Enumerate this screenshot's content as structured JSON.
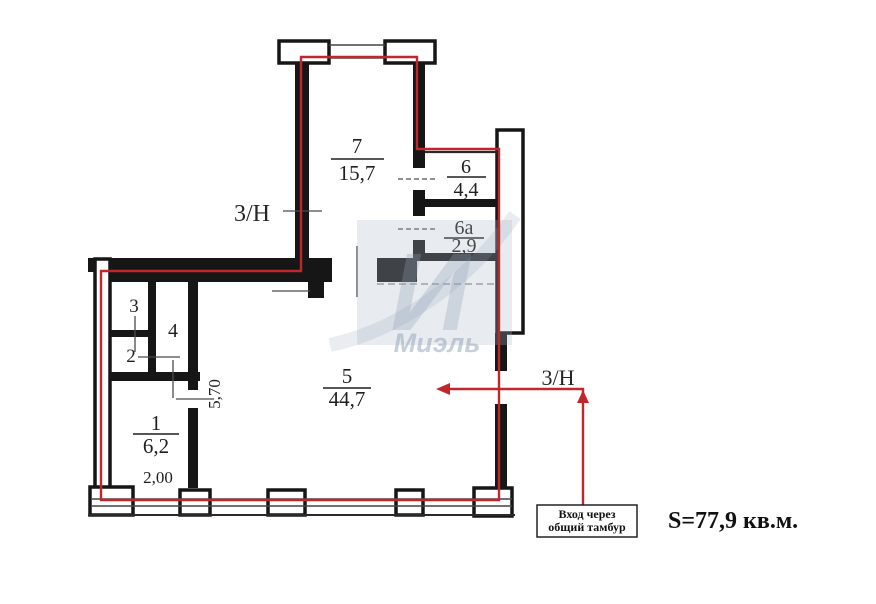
{
  "rooms": {
    "r1": {
      "number": "1",
      "area": "6,2"
    },
    "r2": {
      "number": "2"
    },
    "r3": {
      "number": "3"
    },
    "r4": {
      "number": "4"
    },
    "r5": {
      "number": "5",
      "area": "44,7"
    },
    "r6": {
      "number": "6",
      "area": "4,4"
    },
    "r6a": {
      "number": "6а",
      "area": "2,9"
    },
    "r7": {
      "number": "7",
      "area": "15,7"
    }
  },
  "dimensions": {
    "room1_width": "2,00",
    "room5_height": "5,70"
  },
  "adjacent_labels": {
    "left": "3/Н",
    "right": "3/Н"
  },
  "entrance_note": {
    "line1": "Вход через",
    "line2": "общий тамбур"
  },
  "total_area_label": "S=77,9 кв.м.",
  "watermark": {
    "letter": "И",
    "name": "Миэль"
  },
  "colors": {
    "boundary": "#c0272d",
    "walls": "#161616"
  }
}
